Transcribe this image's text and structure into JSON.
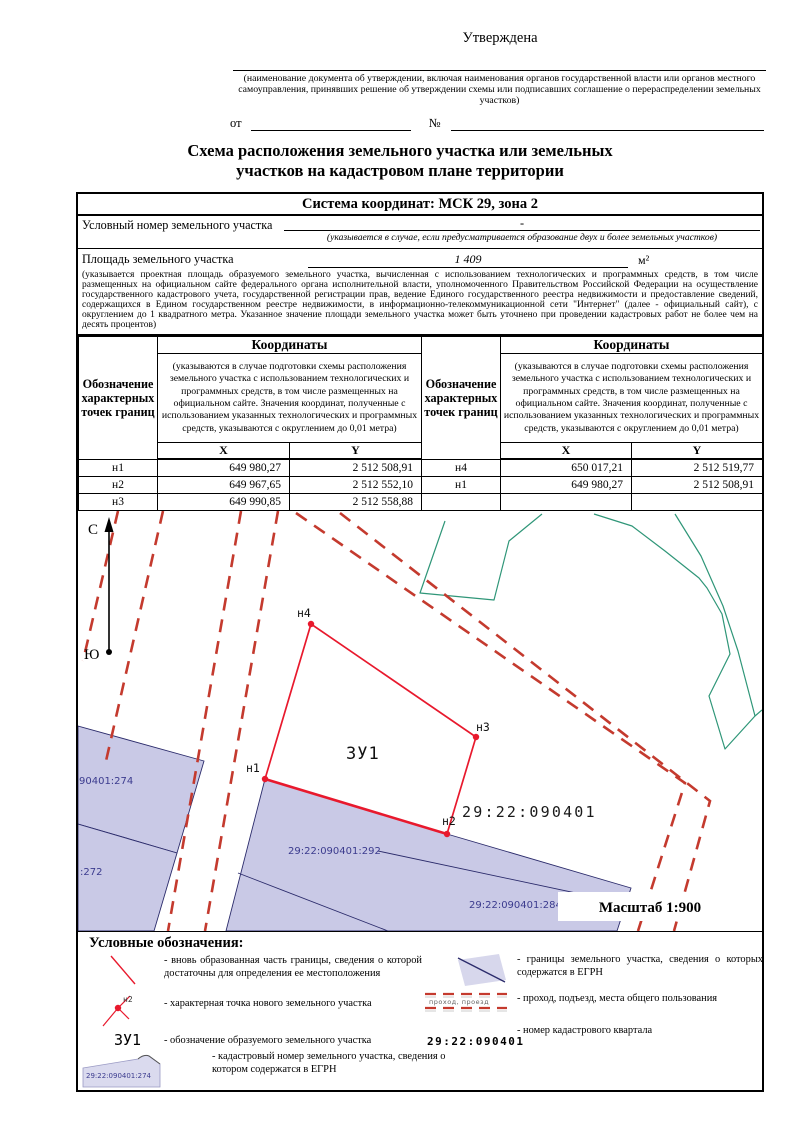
{
  "approval": {
    "approved": "Утверждена",
    "note": "(наименование документа об утверждении, включая наименования органов государственной власти или органов местного самоуправления, принявших решение об утверждении схемы или подписавших соглашение о перераспределении земельных участков)",
    "from_label": "от",
    "number_label": "№"
  },
  "title": {
    "line1": "Схема расположения земельного участка или земельных",
    "line2": "участков на кадастровом плане территории"
  },
  "info": {
    "coord_system": "Система координат: МСК 29, зона 2",
    "cond_label": "Условный номер земельного участка",
    "cond_value": "-",
    "cond_note": "(указывается в случае, если предусматривается образование двух и более земельных участков)",
    "area_label": "Площадь земельного участка",
    "area_value": "1 409",
    "area_unit": "м²",
    "area_note": "(указывается проектная площадь образуемого земельного участка, вычисленная с использованием технологических и программных средств, в том числе размещенных на официальном сайте федерального органа исполнительной власти, уполномоченного Правительством Российской Федерации на осуществление государственного кадастрового учета, государственной регистрации прав, ведение Единого государственного реестра недвижимости и предоставление сведений, содержащихся в Едином государственном реестре недвижимости, в информационно-телекоммуникационной сети \"Интернет\" (далее - официальный сайт), с округлением до 1 квадратного метра. Указанное значение площади земельного участка может быть уточнено при проведении кадастровых работ не более чем на десять процентов)"
  },
  "coords": {
    "points_header": "Обозначение характерных точек границ",
    "coords_header": "Координаты",
    "coords_note": "(указываются в случае подготовки схемы расположения земельного участка с использованием технологических и программных средств, в том числе размещенных на официальном сайте. Значения координат, полученные с использованием указанных технологических и программных средств, указываются с округлением до 0,01 метра)",
    "x_header": "X",
    "y_header": "Y",
    "left_rows": [
      {
        "p": "н1",
        "x": "649 980,27",
        "y": "2 512 508,91"
      },
      {
        "p": "н2",
        "x": "649 967,65",
        "y": "2 512 552,10"
      },
      {
        "p": "н3",
        "x": "649 990,85",
        "y": "2 512 558,88"
      }
    ],
    "right_rows": [
      {
        "p": "н4",
        "x": "650 017,21",
        "y": "2 512 519,77"
      },
      {
        "p": "н1",
        "x": "649 980,27",
        "y": "2 512 508,91"
      },
      {
        "p": "",
        "x": "",
        "y": ""
      }
    ]
  },
  "map": {
    "north": "С",
    "south": "Ю",
    "plot_label": "ЗУ1",
    "quarter_number": "29:22:090401",
    "scale": "Масштаб 1:900",
    "point_n1": "н1",
    "point_n2": "н2",
    "point_n3": "н3",
    "point_n4": "н4",
    "parcel_274": "90401:274",
    "parcel_272": ":272",
    "parcel_292": "29:22:090401:292",
    "parcel_284": "29:22:090401:284",
    "colors": {
      "new_boundary_red": "#e8192d",
      "road_dash_red": "#c43a2e",
      "parcel_fill": "#c9c9e6",
      "parcel_stroke": "#2b2b6b",
      "parcel_label": "#3b3b8e",
      "green_line": "#2f9678"
    }
  },
  "legend": {
    "heading": "Условные обозначения:",
    "left": [
      {
        "text": "- вновь образованная часть границы, сведения о которой достаточны для определения ее местоположения"
      },
      {
        "text": "- характерная точка нового земельного участка",
        "symbol_label": "н2"
      },
      {
        "text": "- обозначение образуемого земельного участка",
        "symbol_label": "ЗУ1"
      },
      {
        "text": "- кадастровый номер земельного участка, сведения о котором содержатся в ЕГРН",
        "symbol_label": "29:22:090401:274"
      }
    ],
    "right": [
      {
        "text": "- границы земельного участка, сведения о которых содержатся в ЕГРН"
      },
      {
        "text": "- проход, подъезд, места общего пользования",
        "symbol_label": "проход,  проезд"
      },
      {
        "text": "- номер кадастрового квартала",
        "symbol_label": "29:22:090401"
      }
    ]
  }
}
